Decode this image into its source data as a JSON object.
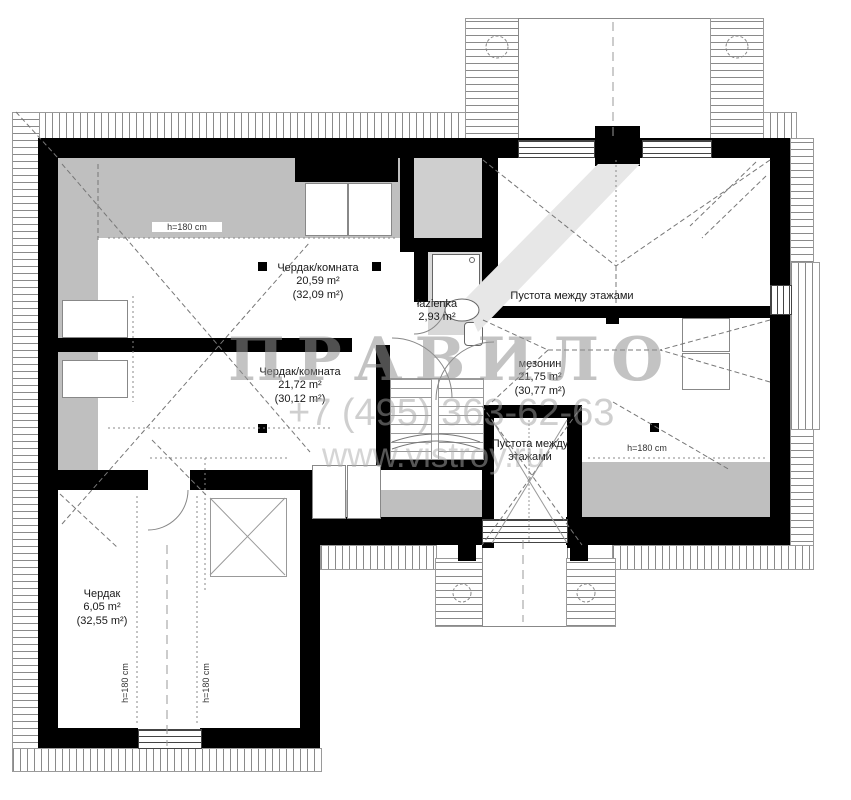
{
  "watermark": {
    "logo": "ПРАВИЛО",
    "phone": "+7 (495) 363-62-63",
    "site": "www.vistroy.ru"
  },
  "rooms": {
    "room1": {
      "name": "Чердак/комната",
      "area": "20,59 m²",
      "area_total": "(32,09 m²)"
    },
    "room2": {
      "name": "Чердак/комната",
      "area": "21,72 m²",
      "area_total": "(30,12 m²)"
    },
    "bathroom": {
      "name": "łazienka",
      "area": "2,93 m²"
    },
    "void_top": {
      "name": "Пустота между этажами"
    },
    "mezzanine": {
      "name": "мезонин",
      "area": "21,75 m²",
      "area_total": "(30,77 m²)"
    },
    "void_shaft": {
      "name": "Пустота между этажами"
    },
    "attic": {
      "name": "Чердак",
      "area": "6,05 m²",
      "area_total": "(32,55 m²)"
    }
  },
  "height_marks": {
    "room1": "h=180 cm",
    "mezzanine": "h=180 cm",
    "attic_left": "h=180 cm",
    "attic_right": "h=180 cm"
  }
}
